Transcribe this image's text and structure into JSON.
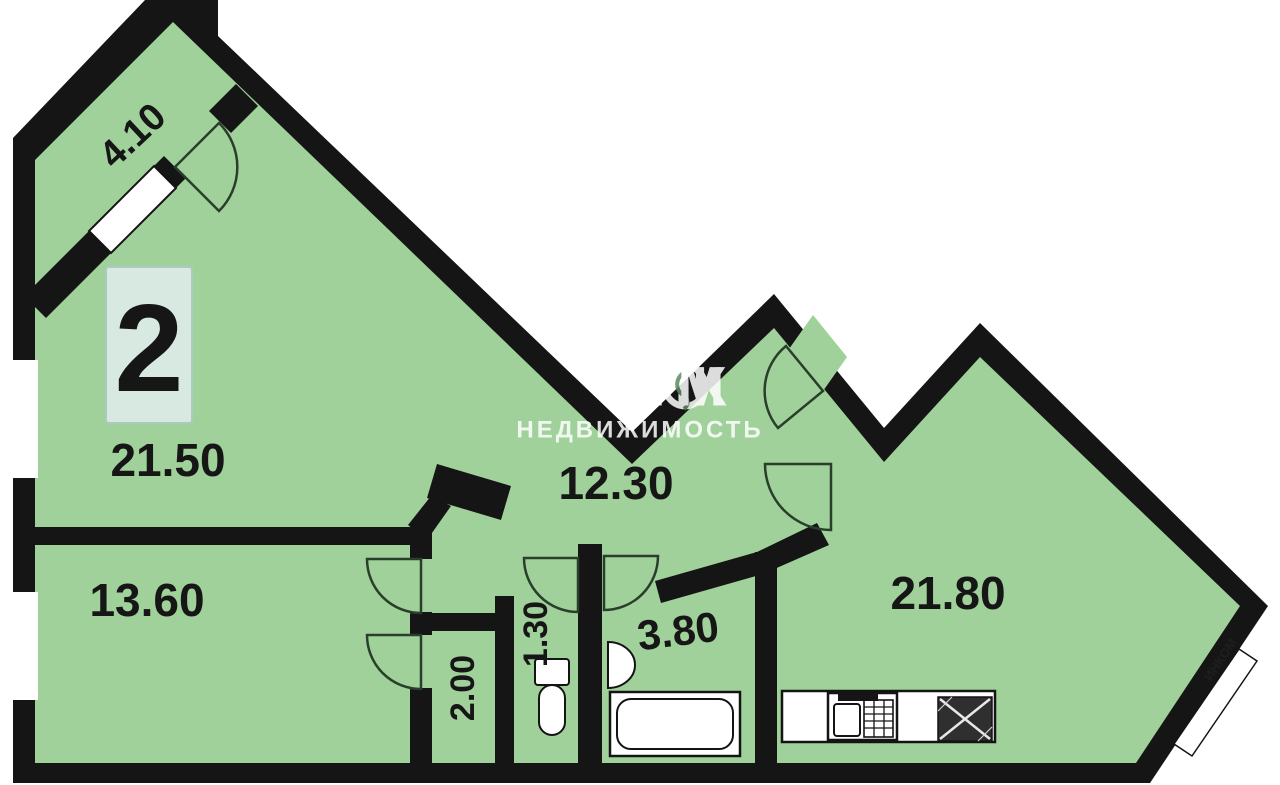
{
  "floor_plan": {
    "apartment_number": "2",
    "rooms": {
      "loggia": {
        "name": "loggia",
        "area": "4.10"
      },
      "living_room": {
        "name": "living-room",
        "area": "21.50"
      },
      "hallway": {
        "name": "hallway",
        "area": "12.30"
      },
      "bedroom": {
        "name": "bedroom",
        "area": "13.60"
      },
      "storage": {
        "name": "storage-closet",
        "area": "2.00"
      },
      "wc": {
        "name": "wc",
        "area": "1.30"
      },
      "bathroom": {
        "name": "bathroom",
        "area": "3.80"
      },
      "kitchen_living": {
        "name": "kitchen-living-room",
        "area": "21.80"
      }
    },
    "watermark": {
      "text_before_logo": "ИНК",
      "text_after_logo": "М",
      "subtitle": "НЕДВИЖИМОСТЬ",
      "corner_text": "ИНКОМ"
    },
    "colors": {
      "floor": "#a0d19a",
      "walls": "#151515",
      "apartment_number_color": "#2b4fa5",
      "apartment_badge_bg": "#d8e9e2",
      "label_color": "#161616",
      "watermark_color": "#ffffff"
    },
    "fixtures": [
      "bathtub",
      "washbasin",
      "toilet",
      "kitchen-counter",
      "kitchen-sink",
      "stove"
    ]
  }
}
